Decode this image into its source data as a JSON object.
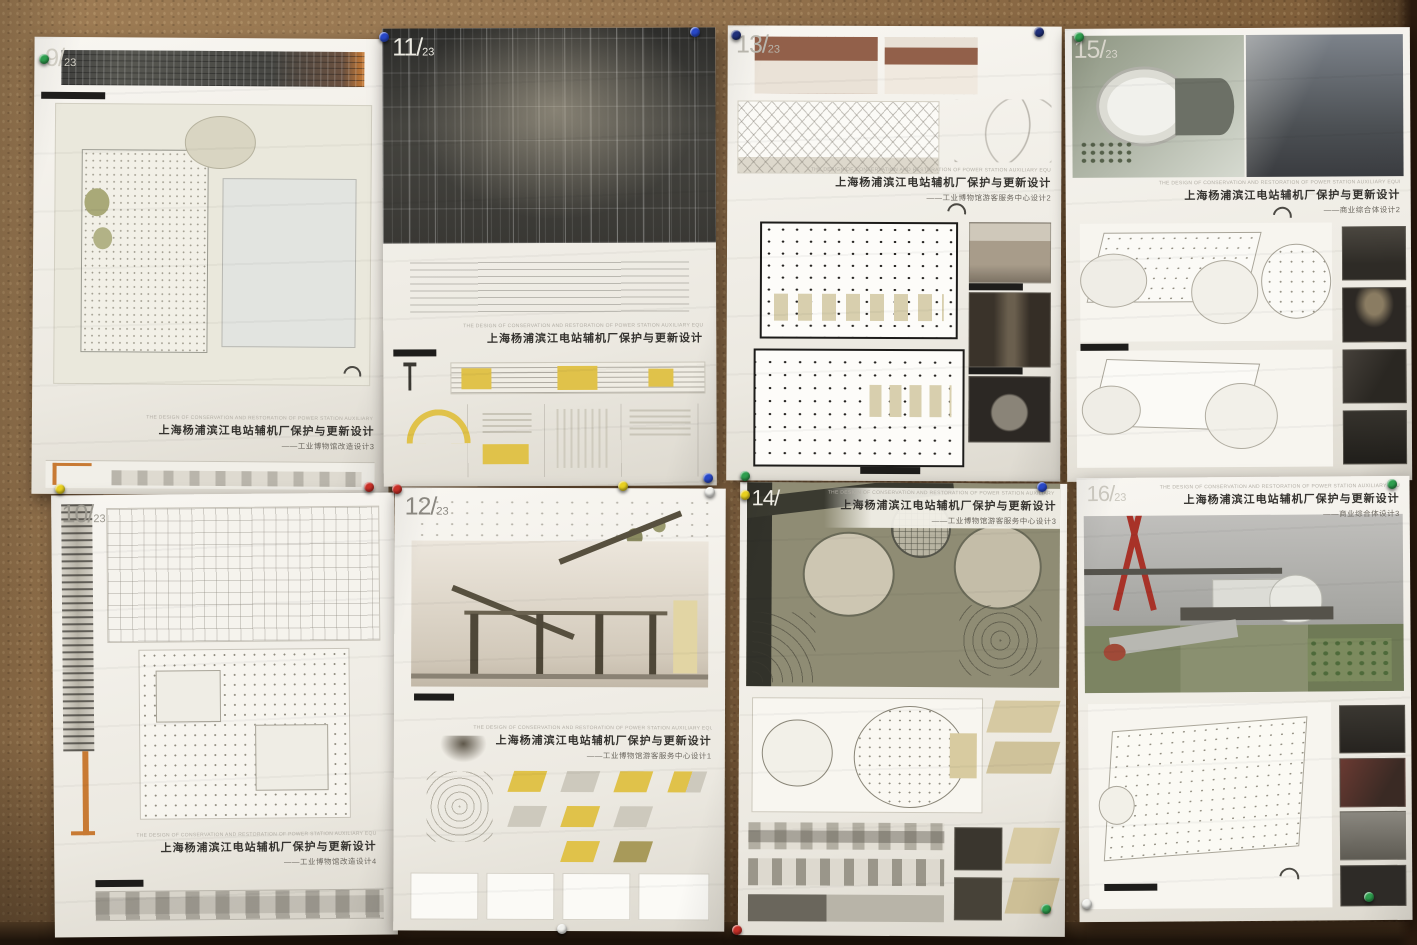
{
  "scene": {
    "board": {
      "cork_color": "#8a6843",
      "floor_color": "#1e140b"
    }
  },
  "colors": {
    "highlight_yellow": "#e0c24a",
    "roof_brown": "#92604a",
    "bridge_red": "#a83228",
    "crane_orange": "#c87a33",
    "pin_green": "#2e9e4e",
    "pin_blue": "#2848c8",
    "pin_navy": "#20307a",
    "pin_red": "#c83028",
    "pin_yellow": "#e8d020",
    "pin_white": "#f0f0ec"
  },
  "posters": [
    {
      "num": "9/",
      "den": "23",
      "title_en": "THE DESIGN OF CONSERVATION AND RESTORATION OF POWER STATION AUXILIARY EQUIPMENT FACTORY IN SHANGHAI NEAR HUANGPU RIVER",
      "title_cn": "上海杨浦滨江电站辅机厂保护与更新设计",
      "subtitle": "——工业博物馆改造设计3"
    },
    {
      "num": "11/",
      "den": "23",
      "title_en": "THE DESIGN OF CONSERVATION AND RESTORATION OF POWER STATION AUXILIARY EQUIPMENT FACTORY IN SHANGHAI NEAR HUANGPU RIVER",
      "title_cn": "上海杨浦滨江电站辅机厂保护与更新设计",
      "subtitle": ""
    },
    {
      "num": "13/",
      "den": "23",
      "title_en": "THE DESIGN OF CONSERVATION AND RESTORATION OF POWER STATION AUXILIARY EQUIPMENT FACTORY IN SHANGHAI NEAR HUANGPU RIVER",
      "title_cn": "上海杨浦滨江电站辅机厂保护与更新设计",
      "subtitle": "——工业博物馆游客服务中心设计2"
    },
    {
      "num": "15/",
      "den": "23",
      "title_en": "THE DESIGN OF CONSERVATION AND RESTORATION OF POWER STATION AUXILIARY EQUIPMENT FACTORY IN SHANGHAI NEAR HUANGPU RIVER",
      "title_cn": "上海杨浦滨江电站辅机厂保护与更新设计",
      "subtitle": "——商业综合体设计2"
    },
    {
      "num": "10/",
      "den": "23",
      "title_en": "THE DESIGN OF CONSERVATION AND RESTORATION OF POWER STATION AUXILIARY EQUIPMENT FACTORY IN SHANGHAI NEAR HUANGPU RIVER",
      "title_cn": "上海杨浦滨江电站辅机厂保护与更新设计",
      "subtitle": "——工业博物馆改造设计4"
    },
    {
      "num": "12/",
      "den": "23",
      "title_en": "THE DESIGN OF CONSERVATION AND RESTORATION OF POWER STATION AUXILIARY EQUIPMENT FACTORY IN SHANGHAI NEAR HUANGPU RIVER",
      "title_cn": "上海杨浦滨江电站辅机厂保护与更新设计",
      "subtitle": "——工业博物馆游客服务中心设计1"
    },
    {
      "num": "14/",
      "den": "",
      "title_en": "THE DESIGN OF CONSERVATION AND RESTORATION OF POWER STATION AUXILIARY EQUIPMENT FACTORY IN SHANGHAI NEAR HUANGPU RIVER",
      "title_cn": "上海杨浦滨江电站辅机厂保护与更新设计",
      "subtitle": "——工业博物馆游客服务中心设计3"
    },
    {
      "num": "16/",
      "den": "23",
      "title_en": "THE DESIGN OF CONSERVATION AND RESTORATION OF POWER STATION AUXILIARY EQUIPMENT FACTORY IN SHANGHAI NEAR HUANGPU RIVER",
      "title_cn": "上海杨浦滨江电站辅机厂保护与更新设计",
      "subtitle": "——商业综合体设计3"
    }
  ],
  "pins": [
    {
      "color": "#2e9e4e",
      "x": 44,
      "y": 59
    },
    {
      "color": "#2848c8",
      "x": 384,
      "y": 37
    },
    {
      "color": "#2848c8",
      "x": 695,
      "y": 32
    },
    {
      "color": "#20307a",
      "x": 736,
      "y": 35
    },
    {
      "color": "#20307a",
      "x": 1039,
      "y": 32
    },
    {
      "color": "#2e9e4e",
      "x": 1079,
      "y": 37
    },
    {
      "color": "#c83028",
      "x": 369,
      "y": 487
    },
    {
      "color": "#c83028",
      "x": 397,
      "y": 489
    },
    {
      "color": "#e8d020",
      "x": 623,
      "y": 486
    },
    {
      "color": "#2848c8",
      "x": 708,
      "y": 478
    },
    {
      "color": "#2e9e4e",
      "x": 745,
      "y": 476
    },
    {
      "color": "#f0f0ec",
      "x": 710,
      "y": 492
    },
    {
      "color": "#e8d020",
      "x": 745,
      "y": 495
    },
    {
      "color": "#e8d020",
      "x": 60,
      "y": 489
    },
    {
      "color": "#2848c8",
      "x": 1042,
      "y": 487
    },
    {
      "color": "#2e9e4e",
      "x": 1392,
      "y": 484
    },
    {
      "color": "#2e9e4e",
      "x": 1369,
      "y": 897
    },
    {
      "color": "#2e9e4e",
      "x": 1046,
      "y": 909
    },
    {
      "color": "#f0f0ec",
      "x": 1087,
      "y": 904
    },
    {
      "color": "#f0f0ec",
      "x": 562,
      "y": 929
    },
    {
      "color": "#c83028",
      "x": 737,
      "y": 930
    }
  ]
}
